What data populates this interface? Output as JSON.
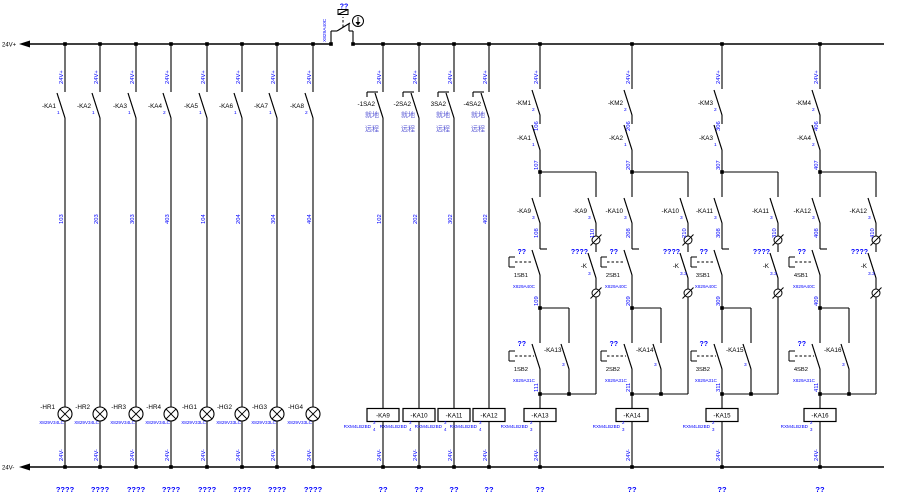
{
  "palette": {
    "wire": "#000000",
    "tag_blue": "#0000ff",
    "cjk_purple": "#5b5bd6"
  },
  "rails": {
    "top_label": "24V+",
    "bottom_label": "24V-"
  },
  "estop": {
    "q": "??",
    "cable": "X829A40C"
  },
  "lamp_columns": [
    {
      "top": "24V+",
      "contact": "-KA1",
      "pin": "1",
      "wire": "103",
      "lamp": "-HR1",
      "cable": "X829V34LC",
      "bottom": "24V-",
      "footer": "????"
    },
    {
      "top": "24V+",
      "contact": "-KA2",
      "pin": "1",
      "wire": "203",
      "lamp": "-HR2",
      "cable": "X829V34LC",
      "bottom": "24V-",
      "footer": "????"
    },
    {
      "top": "24V+",
      "contact": "-KA3",
      "pin": "1",
      "wire": "303",
      "lamp": "-HR3",
      "cable": "X829V34LC",
      "bottom": "24V-",
      "footer": "????"
    },
    {
      "top": "24V+",
      "contact": "-KA4",
      "pin": "2",
      "wire": "403",
      "lamp": "-HR4",
      "cable": "X829V34LC",
      "bottom": "24V-",
      "footer": "????"
    },
    {
      "top": "24V+",
      "contact": "-KA5",
      "pin": "1",
      "wire": "104",
      "lamp": "-HG1",
      "cable": "X829V33LC",
      "bottom": "24V-",
      "footer": "????"
    },
    {
      "top": "24V+",
      "contact": "-KA6",
      "pin": "1",
      "wire": "204",
      "lamp": "-HG2",
      "cable": "X829V33LC",
      "bottom": "24V-",
      "footer": "????"
    },
    {
      "top": "24V+",
      "contact": "-KA7",
      "pin": "1",
      "wire": "304",
      "lamp": "-HG3",
      "cable": "X829V33LC",
      "bottom": "24V-",
      "footer": "????"
    },
    {
      "top": "24V+",
      "contact": "-KA8",
      "pin": "2",
      "wire": "404",
      "lamp": "-HG4",
      "cable": "X829V33LC",
      "bottom": "24V-",
      "footer": "????"
    }
  ],
  "selector_columns": [
    {
      "top": "24V+",
      "switch": "-1SA2",
      "local": "就地",
      "remote": "远程",
      "wire": "102",
      "coil": "-KA9",
      "coil_type": "RXM4LB2BD",
      "pin_top": "3",
      "pin_bottom": "4",
      "bottom": "24V-",
      "footer": "??"
    },
    {
      "top": "24V+",
      "switch": "-2SA2",
      "local": "就地",
      "remote": "远程",
      "wire": "202",
      "coil": "-KA10",
      "coil_type": "RXM4LB2BD",
      "pin_top": "3",
      "pin_bottom": "4",
      "bottom": "24V-",
      "footer": "??"
    },
    {
      "top": "24V+",
      "switch": "3SA2",
      "local": "就地",
      "remote": "远程",
      "wire": "302",
      "coil": "-KA11",
      "coil_type": "RXM4LB2BD",
      "pin_top": "3",
      "pin_bottom": "4",
      "bottom": "24V-",
      "footer": "??"
    },
    {
      "top": "24V+",
      "switch": "-4SA2",
      "local": "就地",
      "remote": "远程",
      "wire": "402",
      "coil": "-KA12",
      "coil_type": "RXM4LB2BD",
      "pin_top": "3",
      "pin_bottom": "4",
      "bottom": "24V-",
      "footer": "??"
    }
  ],
  "km_columns": [
    {
      "top": "24V+",
      "km": "-KM1",
      "km_pin": "2",
      "w1": "106",
      "ka": "-KA1",
      "ka_pin": "1",
      "w2": "107",
      "ka2": "-KA9",
      "ka2_pin": "3",
      "w3": "108",
      "q1": "??",
      "sb1": "1SB1",
      "sb1_cable": "X829A40C",
      "w4": "109",
      "q2": "??",
      "sb2": "1SB2",
      "sb2_cable": "X829A31C",
      "hold": "-KA13",
      "hold_pin": "3",
      "br_contact": "-KA9",
      "br_pin": "3",
      "br_wire": "110",
      "br_q": "????",
      "br_k": "-K",
      "br_k_pin": "3",
      "w5": "111",
      "coil": "-KA13",
      "coil_type": "RXM4LB2BD",
      "pin_top": "2",
      "pin_bottom": "3",
      "bottom": "24V-",
      "footer": "??"
    },
    {
      "top": "24V+",
      "km": "-KM2",
      "km_pin": "2",
      "w1": "206",
      "ka": "-KA2",
      "ka_pin": "1",
      "w2": "207",
      "ka2": "-KA10",
      "ka2_pin": "3",
      "w3": "208",
      "q1": "??",
      "sb1": "2SB1",
      "sb1_cable": "X829A40C",
      "w4": "209",
      "q2": "??",
      "sb2": "2SB2",
      "sb2_cable": "X829A31C",
      "hold": "-KA14",
      "hold_pin": "3",
      "br_contact": "-KA10",
      "br_pin": "3",
      "br_wire": "210",
      "br_q": "????",
      "br_k": "-K",
      "br_k_pin": "3.3",
      "w5": "211",
      "coil": "-KA14",
      "coil_type": "RXM4LB2BD",
      "pin_top": "2",
      "pin_bottom": "3",
      "bottom": "24V-",
      "footer": "??"
    },
    {
      "top": "24V+",
      "km": "-KM3",
      "km_pin": "2",
      "w1": "306",
      "ka": "-KA3",
      "ka_pin": "1",
      "w2": "307",
      "ka2": "-KA11",
      "ka2_pin": "3",
      "w3": "308",
      "q1": "??",
      "sb1": "3SB1",
      "sb1_cable": "X829A40C",
      "w4": "309",
      "q2": "??",
      "sb2": "3SB2",
      "sb2_cable": "X829A31C",
      "hold": "-KA15",
      "hold_pin": "3",
      "br_contact": "-KA11",
      "br_pin": "3",
      "br_wire": "310",
      "br_q": "????",
      "br_k": "-K",
      "br_k_pin": "3.3",
      "w5": "311",
      "coil": "-KA15",
      "coil_type": "RXM4LB2BD",
      "pin_top": "2",
      "pin_bottom": "3",
      "bottom": "24V-",
      "footer": "??"
    },
    {
      "top": "24V+",
      "km": "-KM4",
      "km_pin": "2",
      "w1": "406",
      "ka": "-KA4",
      "ka_pin": "2",
      "w2": "407",
      "ka2": "-KA12",
      "ka2_pin": "3",
      "w3": "408",
      "q1": "??",
      "sb1": "4SB1",
      "sb1_cable": "X829A40C",
      "w4": "409",
      "q2": "??",
      "sb2": "4SB2",
      "sb2_cable": "X829A31C",
      "hold": "-KA16",
      "hold_pin": "3",
      "br_contact": "-KA12",
      "br_pin": "3",
      "br_wire": "410",
      "br_q": "????",
      "br_k": "-K",
      "br_k_pin": "3.3",
      "w5": "411",
      "coil": "-KA16",
      "coil_type": "RXM4LB2BD",
      "pin_top": "2",
      "pin_bottom": "3",
      "bottom": "24V-",
      "footer": "??"
    }
  ]
}
